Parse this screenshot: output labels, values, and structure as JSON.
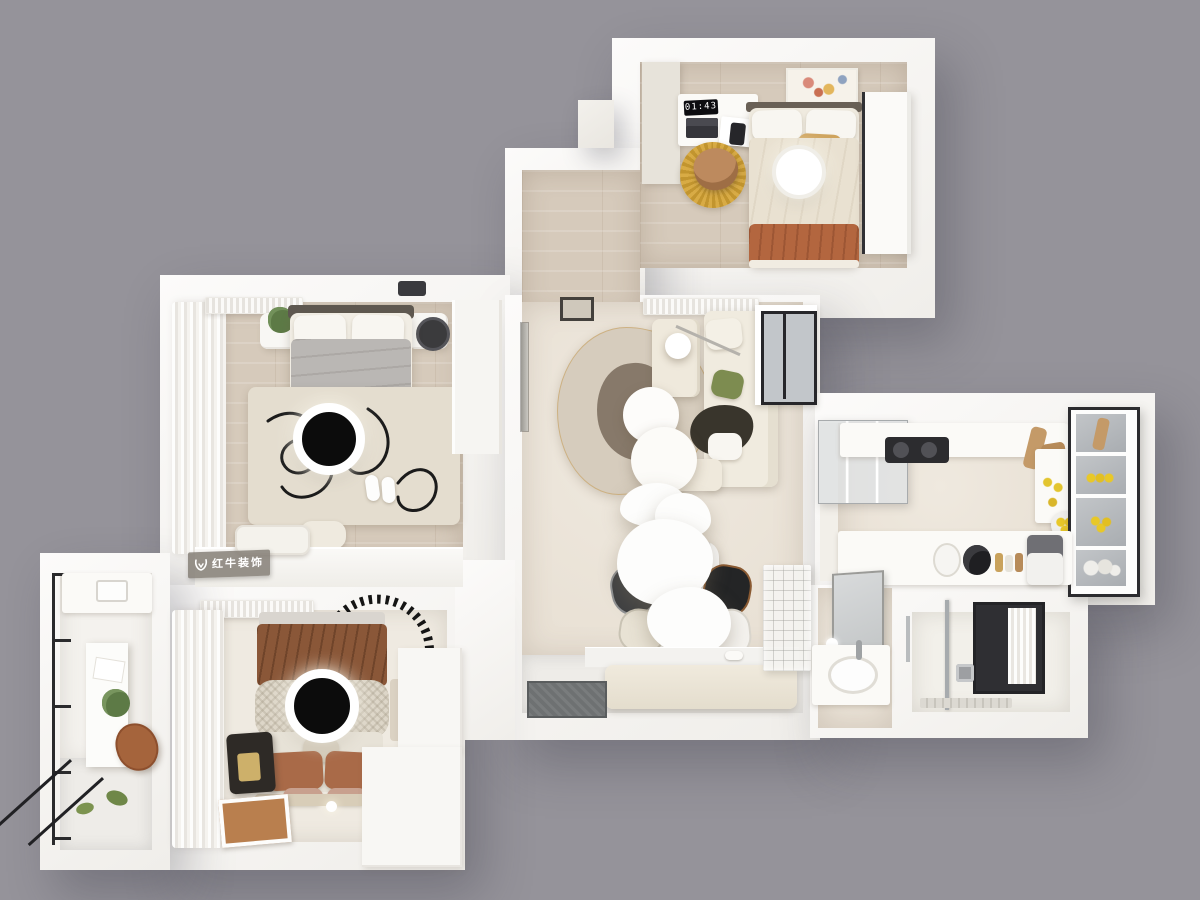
{
  "meta": {
    "render_type": "top-down 3D dollhouse render of an apartment floor plan",
    "background_color": "#95939a"
  },
  "watermark": {
    "brand_text": "红牛装饰"
  },
  "guest_bedroom": {
    "clock_time": "01:43"
  },
  "palette": {
    "background": "#95939a",
    "wall_white": "#f7f5f2",
    "wood_floor": "#d6cabb",
    "cream_floor": "#ece5db",
    "terracotta": "#b2653e",
    "brown_blanket": "#8a5738",
    "mustard_rug": "#d2a43e",
    "sage_green": "#7d8c50",
    "charcoal": "#1c1c1e",
    "glass_gray": "#b9bdc1",
    "marble": "#f3f2ef"
  },
  "scene": {
    "rooms": [
      {
        "name": "guest-bedroom",
        "position": "top-right",
        "furniture": [
          "bed with terracotta throw",
          "white pillows",
          "desk with laptop, notebook, phone and digital clock",
          "round mustard rug",
          "tan desk chair",
          "tall wardrobe",
          "abstract wall art",
          "round ceiling lamp"
        ]
      },
      {
        "name": "hallway",
        "position": "top-center",
        "furniture": [
          "wood flooring",
          "white floor dot"
        ]
      },
      {
        "name": "master-bedroom",
        "position": "middle-left",
        "furniture": [
          "double bed with grey duvet and terracotta runner",
          "two nightstands",
          "potted plant",
          "black table lamp",
          "ivory rug with black scribble pattern",
          "sheer curtains",
          "air conditioner",
          "round ceiling lamp",
          "slippers",
          "low cabinet with cushions"
        ]
      },
      {
        "name": "living-room",
        "position": "center",
        "furniture": [
          "cream sectional sofa",
          "olive cushion",
          "dark throw",
          "round nesting coffee tables",
          "organic two-tone rug",
          "arc floor lamp",
          "black framed window",
          "air conditioner",
          "sculptural white pendant lamps"
        ]
      },
      {
        "name": "dining-area",
        "position": "center-bottom",
        "furniture": [
          "marble dining table with dishes",
          "four mixed chairs",
          "entry bench",
          "glass-block partition",
          "dark doormat"
        ]
      },
      {
        "name": "kitchen",
        "position": "right",
        "furniture": [
          "white counters",
          "dark cooktop",
          "cutting boards",
          "lemons",
          "glass-front pantry cabinet",
          "coffee machine",
          "canisters and bottles",
          "glass sliding door"
        ]
      },
      {
        "name": "bathroom",
        "position": "bottom-right",
        "furniture": [
          "vanity mirror",
          "washbasin",
          "glass shower partition",
          "black framed window with sheer curtain",
          "shower valve",
          "linear floor drain"
        ]
      },
      {
        "name": "second-bedroom",
        "position": "bottom-left",
        "furniture": [
          "bed with brown quilt and knitted runner",
          "terracotta pillows",
          "dashed black arc wall decor",
          "dark suitcase",
          "picture frame on floor",
          "L-shaped wardrobe",
          "air conditioner",
          "round ceiling lamp",
          "sheer curtains"
        ]
      },
      {
        "name": "balcony-study",
        "position": "far-left",
        "furniture": [
          "black framed glazing",
          "white desk",
          "paper sheet",
          "potted plant",
          "leather chair",
          "marble floor"
        ]
      }
    ]
  }
}
